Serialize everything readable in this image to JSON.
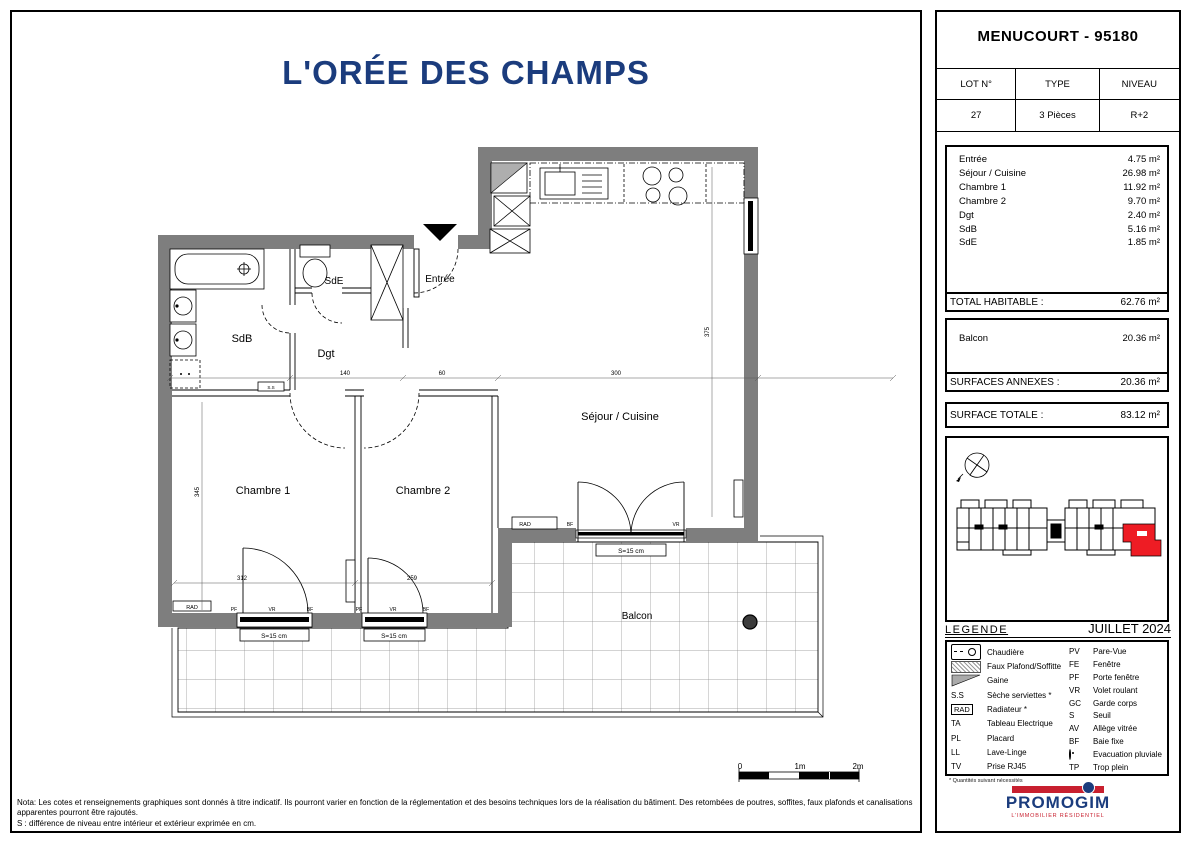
{
  "title": "L'ORÉE DES CHAMPS",
  "plan": {
    "rooms": {
      "entree": "Entrée",
      "sde": "SdE",
      "sdb": "SdB",
      "dgt": "Dgt",
      "chambre1": "Chambre 1",
      "chambre2": "Chambre 2",
      "sejour": "Séjour / Cuisine",
      "balcon": "Balcon"
    },
    "labels": {
      "seuil": "S=15 cm",
      "rad": "RAD",
      "ss": "S.S",
      "pf": "PF",
      "vr": "VR",
      "bf": "BF"
    },
    "dims": {
      "ch1_w": "312",
      "ch2_w": "259",
      "sej_w": "300",
      "sde_w": "140",
      "ent_w": "60",
      "ch1_h": "345",
      "sej_h": "375"
    },
    "scale": {
      "zero": "0",
      "one": "1m",
      "two": "2m"
    },
    "nota1": "Nota: Les cotes et renseignements graphiques sont donnés à titre indicatif. Ils pourront varier en fonction de la réglementation et des besoins techniques lors de la réalisation du bâtiment. Des retombées de poutres, soffites, faux plafonds et canalisations apparentes pourront être rajoutés.",
    "nota2": "S : différence de niveau entre intérieur et extérieur exprimée en cm."
  },
  "panel": {
    "city": "MENUCOURT - 95180",
    "lot": {
      "headers": [
        "LOT N°",
        "TYPE",
        "NIVEAU"
      ],
      "values": [
        "27",
        "3 Pièces",
        "R+2"
      ]
    },
    "surfaces": [
      {
        "label": "Entrée",
        "value": "4.75 m²"
      },
      {
        "label": "Séjour / Cuisine",
        "value": "26.98 m²"
      },
      {
        "label": "Chambre 1",
        "value": "11.92 m²"
      },
      {
        "label": "Chambre 2",
        "value": "9.70 m²"
      },
      {
        "label": "Dgt",
        "value": "2.40 m²"
      },
      {
        "label": "SdB",
        "value": "5.16 m²"
      },
      {
        "label": "SdE",
        "value": "1.85 m²"
      }
    ],
    "total_habitable": {
      "label": "TOTAL HABITABLE :",
      "value": "62.76 m²"
    },
    "balcon": {
      "label": "Balcon",
      "value": "20.36 m²"
    },
    "surfaces_annexes": {
      "label": "SURFACES ANNEXES :",
      "value": "20.36 m²"
    },
    "surface_totale": {
      "label": "SURFACE TOTALE :",
      "value": "83.12 m²"
    },
    "legend": {
      "title": "LEGENDE",
      "date": "JUILLET 2024",
      "left": [
        {
          "icon": "chaudiere-icon",
          "code": "",
          "label": "Chaudière"
        },
        {
          "icon": "faux-plafond-icon",
          "code": "",
          "label": "Faux Plafond/Soffitte"
        },
        {
          "icon": "gaine-icon",
          "code": "",
          "label": "Gaine"
        },
        {
          "icon": "",
          "code": "S.S",
          "label": "Sèche serviettes *"
        },
        {
          "icon": "",
          "code": "RAD",
          "label": "Radiateur *"
        },
        {
          "icon": "",
          "code": "TA",
          "label": "Tableau Electrique"
        },
        {
          "icon": "",
          "code": "PL",
          "label": "Placard"
        },
        {
          "icon": "",
          "code": "LL",
          "label": "Lave-Linge"
        },
        {
          "icon": "",
          "code": "TV",
          "label": "Prise RJ45"
        }
      ],
      "right": [
        {
          "icon": "",
          "code": "PV",
          "label": "Pare-Vue"
        },
        {
          "icon": "",
          "code": "FE",
          "label": "Fenêtre"
        },
        {
          "icon": "",
          "code": "PF",
          "label": "Porte fenêtre"
        },
        {
          "icon": "",
          "code": "VR",
          "label": "Volet roulant"
        },
        {
          "icon": "",
          "code": "GC",
          "label": "Garde corps"
        },
        {
          "icon": "",
          "code": "S",
          "label": "Seuil"
        },
        {
          "icon": "",
          "code": "AV",
          "label": "Allège vitrée"
        },
        {
          "icon": "",
          "code": "BF",
          "label": "Baie fixe"
        },
        {
          "icon": "evac-icon",
          "code": "",
          "label": "Evacuation pluviale"
        },
        {
          "icon": "",
          "code": "TP",
          "label": "Trop plein"
        }
      ],
      "footnote": "* Quantités suivant nécessités"
    },
    "logo": {
      "name": "PROMOGIM",
      "tagline": "L'IMMOBILIER RÉSIDENTIEL"
    }
  }
}
